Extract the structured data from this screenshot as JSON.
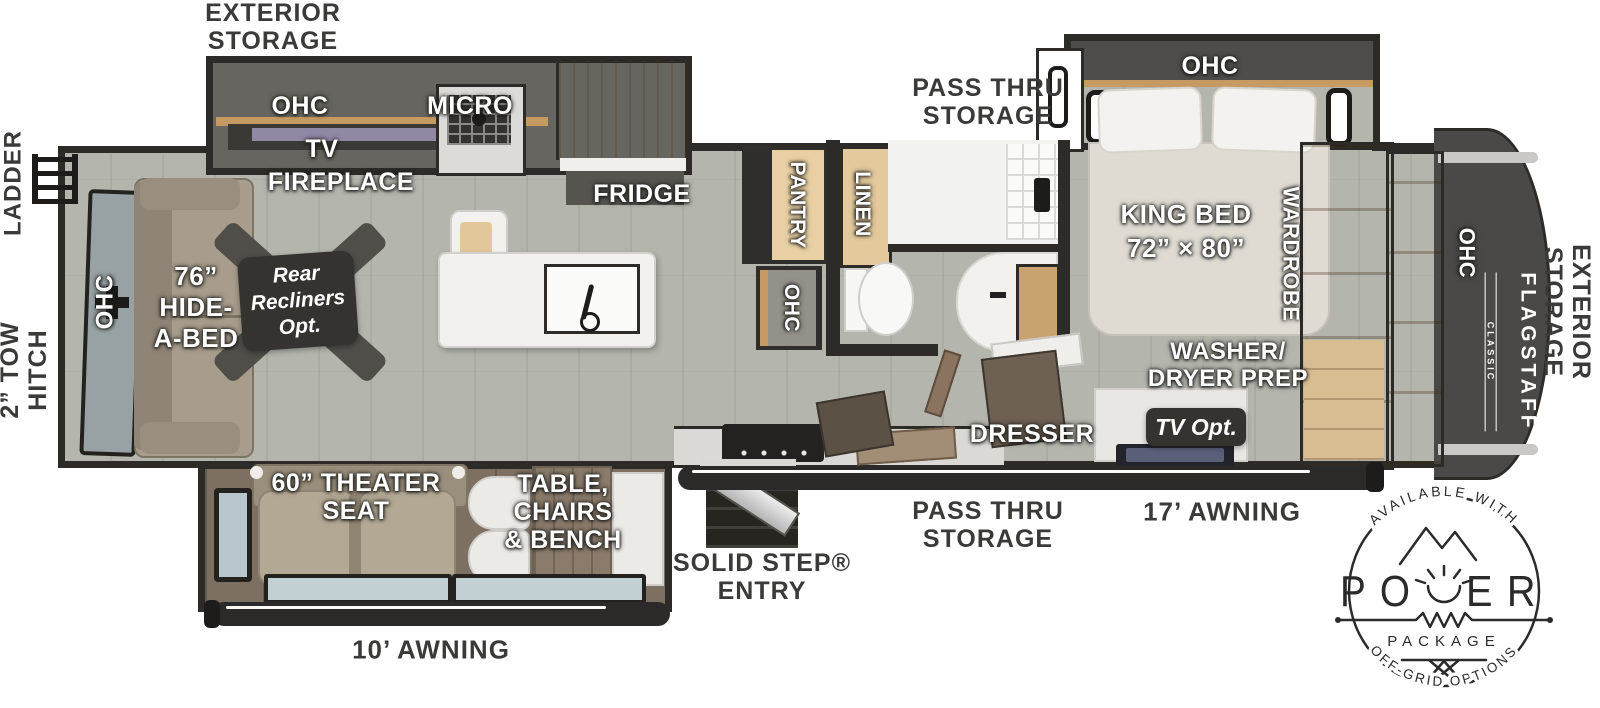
{
  "exterior": {
    "exterior_storage_top": "EXTERIOR\nSTORAGE",
    "ladder": "LADDER",
    "tow_hitch": "2”  TOW\nHITCH",
    "pass_thru_storage_top": "PASS THRU\nSTORAGE",
    "exterior_storage_right": "EXTERIOR\nSTORAGE",
    "pass_thru_storage_bottom": "PASS THRU\nSTORAGE",
    "awning_17": "17’ AWNING",
    "awning_10": "10’ AWNING",
    "solid_step_entry": "SOLID STEP®\nENTRY"
  },
  "interior": {
    "ohc_kitchen": "OHC",
    "micro": "MICRO",
    "tv": "TV",
    "fireplace": "FIREPLACE",
    "fridge": "FRIDGE",
    "pantry": "PANTRY",
    "ohc_pantry": "OHC",
    "linen": "LINEN",
    "ohc_bedroom": "OHC",
    "king_bed": "KING BED\n72” × 80”",
    "wardrobe": "WARDROBE",
    "ohc_front": "OHC",
    "washer_dryer": "WASHER/\nDRYER PREP",
    "dresser": "DRESSER",
    "tv_opt": "TV Opt.",
    "hide_a_bed": "76”\nHIDE-\nA-BED",
    "ohc_rear": "OHC",
    "rear_recliners": "Rear\nRecliners\nOpt.",
    "theater_seat": "60” THEATER\nSEAT",
    "table_chairs": "TABLE,\nCHAIRS\n& BENCH"
  },
  "branding": {
    "flagstaff": "FLAGSTAFF",
    "classic": "CLASSIC"
  },
  "power_badge": {
    "arc_top": "AVAILABLE WITH",
    "power_left": "PO",
    "power_right": "ER",
    "package": "PACKAGE",
    "arc_bottom": "OFF-GRID OPTIONS"
  },
  "icons": {
    "ladder": "ladder-icon",
    "tow_hitch": "hitch-cross-icon",
    "entry_steps": "solid-step-icon",
    "recliner_cross": "recliner-x-icon",
    "power_badge": "power-package-badge",
    "sun": "sun-icon",
    "mountains": "mountains-icon"
  },
  "colors": {
    "wall": "#2c2b28",
    "floor": "#b4b6ae",
    "slide_floor_brown": "#7d7063",
    "cabinet_wood": "#c9a36f",
    "badge_dark": "#343330",
    "front_cap": "#4a4947",
    "label_white": "#ffffff",
    "label_dark": "#3a3a39"
  }
}
